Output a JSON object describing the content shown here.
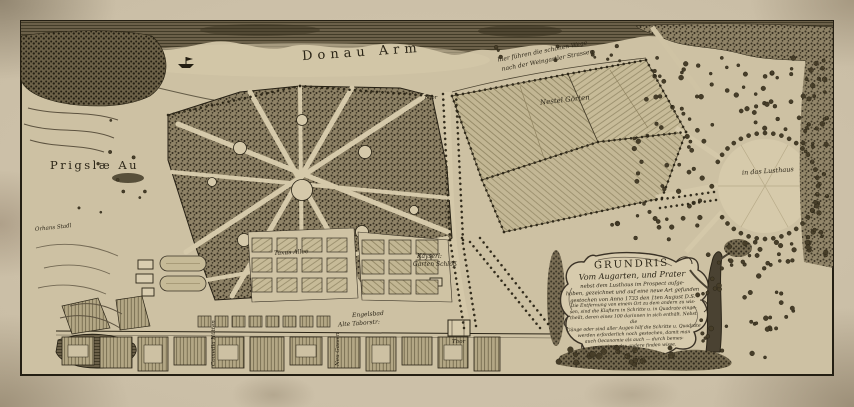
{
  "sheet": {
    "title": "Grundris vom Augarten und Prater (engraved map)"
  },
  "map_labels": {
    "donau_arm": "Donau Arm",
    "prigslae_au": "Prigslæ Au",
    "nestel_gorten": "Nestel Görten",
    "weg_line1": "hier führen die schönen Wege",
    "weg_line2": "nach der Weingartler Strassen",
    "lusthaus": "in das Lusthaus",
    "kays_line1": "Käyserl:",
    "kays_line2": "Garten Schlöß",
    "taxus_allee": "Taxus Allee",
    "orhans_stadl": "Orhans Stadl",
    "engelsbad": "Engelsbad",
    "alte_tabor": "Alte Taborstr:",
    "comedia": "Comedia Hütten",
    "neu_gassen": "Neu Gassen",
    "thor_top": "Thor",
    "thor_bottom": "Thor"
  },
  "cartouche": {
    "title": "GRUNDRIS",
    "subtitle": "Vom Augarten, und Prater",
    "mid_lines": [
      "nebst dem Lusthaus im Prospect aufge-",
      "hoben, gezeichnet und auf eine neue Art gefunden",
      "gestochen von Anno 1733 den 1ten August D.S."
    ],
    "small_lines": [
      "Die Entfernung von einem Ort zu dem andern zu wis-",
      "sen, sind die Klaftern in Schritte u. in Quadrate einge-",
      "theilt, deren eines 100 darinnen in sich enthält. Nebst die",
      "Gänge oder sind aller Augen hilf die Schritte u. Quadrate",
      "werden erforderlich noch gestochen, damit man",
      "auch Oeconomie als auch — durch bemes-",
      "sung eines das andere finden wisse."
    ]
  },
  "colors": {
    "paper_margin": "#ccc0a9",
    "paper_plate": "#cdc1a3",
    "ink": "#2b2517",
    "woods": "#6c6148",
    "corner_stain": "#8a7b63"
  }
}
